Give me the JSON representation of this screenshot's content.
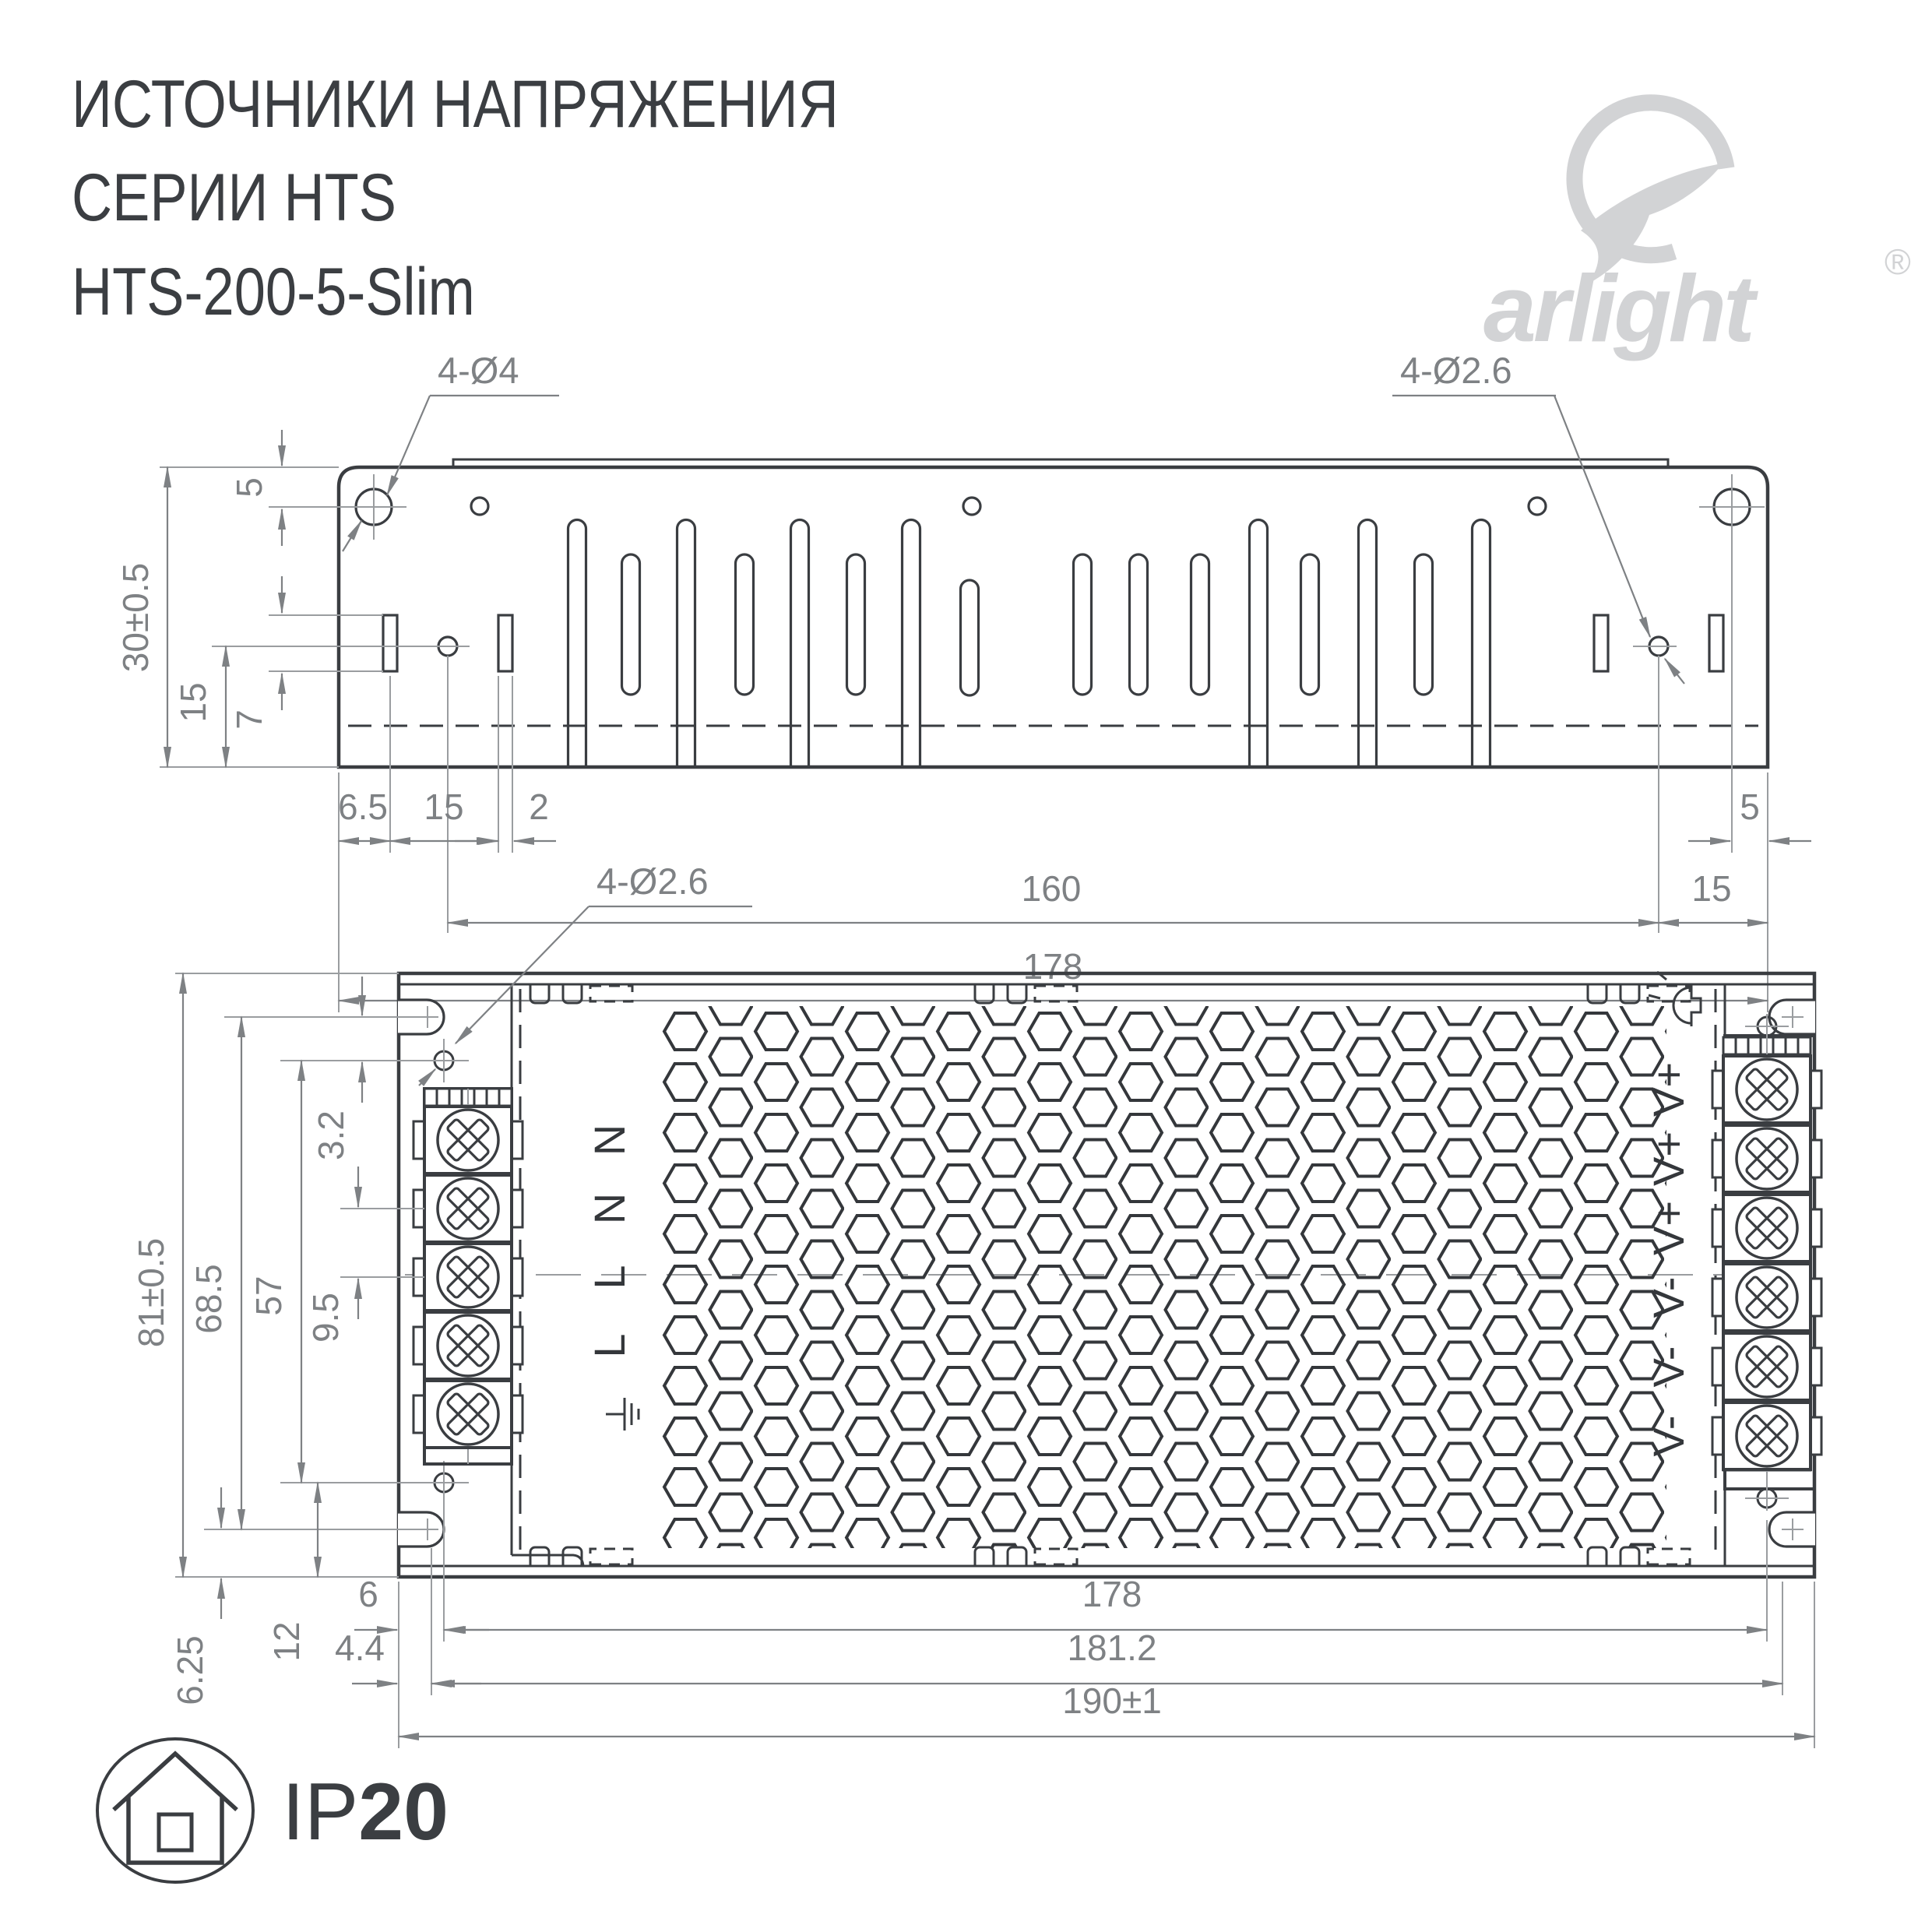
{
  "title": {
    "line1": "ИСТОЧНИКИ НАПРЯЖЕНИЯ",
    "line2": "СЕРИИ HTS",
    "line3": "HTS-200-5-Slim"
  },
  "logo": {
    "brand": "arlight",
    "registered": "®"
  },
  "top_view": {
    "label_holes_large": "4-Ø4",
    "label_holes_small": "4-Ø2.6",
    "dim_height": "30±0.5",
    "dim_top_to_hole": "5",
    "dim_slot_height": "7",
    "dim_hole_to_bottom": "15",
    "dim_edge_to_slot": "6.5",
    "dim_slot_spacing": "15",
    "dim_slot_width": "2",
    "dim_hole_spacing": "160",
    "dim_hole_to_edge_right": "15",
    "dim_total_width": "178",
    "dim_hole_right": "5"
  },
  "bottom_view": {
    "label_holes": "4-Ø2.6",
    "dim_height": "81±0.5",
    "dim_notch_spacing": "68.5",
    "dim_hole_spacing": "57",
    "dim_terminal_pitch": "9.5",
    "dim_notch_to_hole": "3.2",
    "dim_notch_to_bottom": "6.25",
    "dim_hole_to_bottom": "12",
    "dim_edge_to_hole": "6",
    "dim_edge_to_cover": "4.4",
    "dim_body_width": "178",
    "dim_cover_width": "181.2",
    "dim_total_width": "190±1",
    "input_terminals": [
      "N",
      "N",
      "L",
      "L"
    ],
    "output_terminals": [
      "V+",
      "V+",
      "V+",
      "V-",
      "V-",
      "V-"
    ]
  },
  "footer": {
    "ip_code": "IP",
    "ip_rating": "20"
  }
}
